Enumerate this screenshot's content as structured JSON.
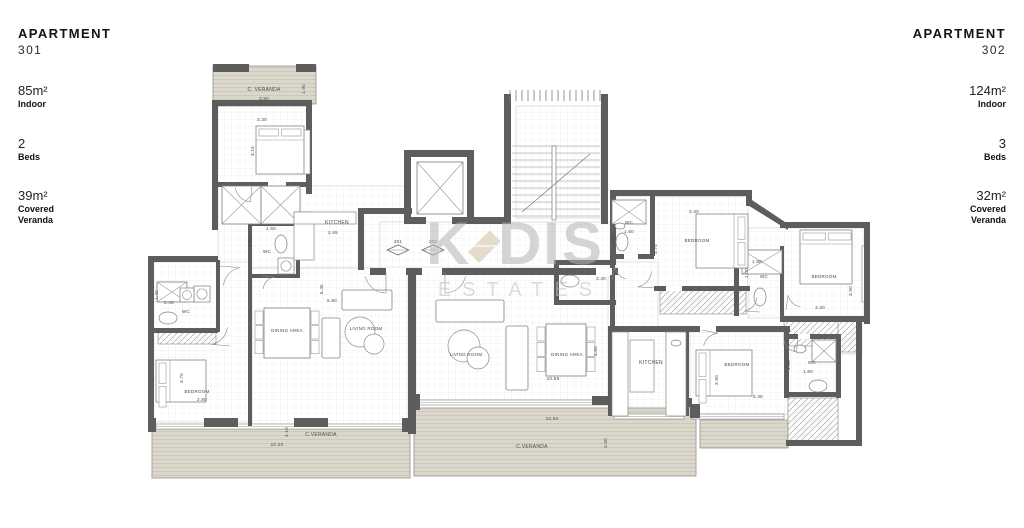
{
  "left_panel": {
    "title": "APARTMENT",
    "number": "301",
    "stats": [
      {
        "value": "85m²",
        "label": "Indoor"
      },
      {
        "value": "2",
        "label": "Beds"
      },
      {
        "value": "39m²",
        "label": "Covered\nVeranda"
      }
    ]
  },
  "right_panel": {
    "title": "APARTMENT",
    "number": "302",
    "stats": [
      {
        "value": "124m²",
        "label": "Indoor"
      },
      {
        "value": "3",
        "label": "Beds"
      },
      {
        "value": "32m²",
        "label": "Covered\nVeranda"
      }
    ]
  },
  "watermark": {
    "k": "K",
    "dis": "DIS",
    "estates": "ESTATES"
  },
  "colors": {
    "wall": "#5d5d5d",
    "deck": "#dbd7ca",
    "deck_line": "#c9c5b8",
    "grid_line": "#ececec",
    "label": "#4a4a4a",
    "watermark_gray": "#b5b5b5",
    "watermark_diamond": "#d4c1a4"
  },
  "floorplan": {
    "interiors": [
      [
        218,
        106,
        92,
        78
      ],
      [
        218,
        186,
        190,
        82
      ],
      [
        152,
        262,
        98,
        160
      ],
      [
        252,
        268,
        156,
        156
      ],
      [
        380,
        222,
        236,
        46
      ],
      [
        516,
        106,
        85,
        112
      ],
      [
        612,
        196,
        136,
        92
      ],
      [
        556,
        262,
        60,
        40
      ],
      [
        612,
        262,
        46,
        66
      ],
      [
        748,
        228,
        116,
        90
      ],
      [
        416,
        270,
        192,
        130
      ],
      [
        612,
        330,
        76,
        84
      ],
      [
        690,
        332,
        98,
        82
      ],
      [
        788,
        338,
        48,
        58
      ],
      [
        788,
        396,
        50,
        46
      ],
      [
        838,
        318,
        24,
        36
      ]
    ],
    "verandas": [
      [
        213,
        66,
        103,
        38
      ],
      [
        152,
        428,
        258,
        50
      ],
      [
        414,
        408,
        282,
        68
      ],
      [
        700,
        420,
        88,
        28
      ]
    ],
    "hatches": [
      [
        158,
        330,
        58,
        14
      ],
      [
        660,
        290,
        86,
        24
      ],
      [
        784,
        318,
        76,
        28
      ],
      [
        788,
        398,
        50,
        44
      ],
      [
        838,
        318,
        22,
        34
      ]
    ],
    "windows": [
      [
        218,
        101,
        90,
        5
      ],
      [
        156,
        424,
        250,
        5
      ],
      [
        416,
        400,
        192,
        5
      ],
      [
        656,
        191,
        88,
        5
      ],
      [
        862,
        246,
        5,
        56
      ],
      [
        692,
        414,
        92,
        5
      ],
      [
        614,
        414,
        70,
        5
      ]
    ],
    "walls": [
      [
        213,
        64,
        36,
        8
      ],
      [
        296,
        64,
        20,
        8
      ],
      [
        212,
        100,
        6,
        130
      ],
      [
        148,
        256,
        70,
        6
      ],
      [
        148,
        256,
        6,
        170
      ],
      [
        212,
        100,
        100,
        6
      ],
      [
        306,
        100,
        6,
        94
      ],
      [
        216,
        182,
        96,
        5
      ],
      [
        248,
        222,
        52,
        4
      ],
      [
        248,
        222,
        4,
        56
      ],
      [
        296,
        222,
        4,
        56
      ],
      [
        248,
        274,
        52,
        4
      ],
      [
        216,
        260,
        4,
        72
      ],
      [
        148,
        328,
        70,
        5
      ],
      [
        248,
        278,
        4,
        148
      ],
      [
        358,
        208,
        54,
        6
      ],
      [
        358,
        208,
        6,
        62
      ],
      [
        408,
        268,
        8,
        166
      ],
      [
        370,
        268,
        248,
        7
      ],
      [
        404,
        150,
        70,
        7
      ],
      [
        404,
        150,
        7,
        74
      ],
      [
        467,
        150,
        7,
        74
      ],
      [
        404,
        217,
        22,
        7
      ],
      [
        452,
        217,
        22,
        7
      ],
      [
        504,
        94,
        7,
        130
      ],
      [
        601,
        94,
        7,
        130
      ],
      [
        472,
        217,
        34,
        7
      ],
      [
        610,
        190,
        6,
        74
      ],
      [
        610,
        190,
        142,
        6
      ],
      [
        650,
        196,
        5,
        60
      ],
      [
        610,
        254,
        44,
        5
      ],
      [
        654,
        286,
        96,
        5
      ],
      [
        746,
        190,
        6,
        16
      ],
      [
        780,
        222,
        90,
        6
      ],
      [
        864,
        222,
        6,
        102
      ],
      [
        780,
        246,
        4,
        70
      ],
      [
        734,
        246,
        5,
        70
      ],
      [
        610,
        260,
        5,
        72
      ],
      [
        554,
        260,
        62,
        5
      ],
      [
        554,
        260,
        5,
        44
      ],
      [
        554,
        300,
        62,
        5
      ],
      [
        610,
        326,
        180,
        6
      ],
      [
        608,
        326,
        6,
        90
      ],
      [
        684,
        330,
        5,
        86
      ],
      [
        784,
        332,
        5,
        66
      ],
      [
        784,
        334,
        56,
        5
      ],
      [
        836,
        334,
        5,
        64
      ],
      [
        784,
        392,
        56,
        5
      ],
      [
        780,
        316,
        90,
        6
      ],
      [
        856,
        318,
        6,
        128
      ],
      [
        786,
        440,
        76,
        6
      ],
      [
        204,
        418,
        34,
        9
      ],
      [
        294,
        418,
        34,
        9
      ],
      [
        148,
        418,
        8,
        14
      ],
      [
        402,
        418,
        12,
        14
      ],
      [
        592,
        396,
        26,
        9
      ],
      [
        666,
        398,
        26,
        9
      ],
      [
        412,
        394,
        8,
        16
      ],
      [
        690,
        404,
        10,
        14
      ]
    ],
    "polys": [
      "746,196 788,224 788,230 746,204"
    ],
    "gaps": [
      [
        386,
        268,
        20,
        7
      ],
      [
        422,
        268,
        20,
        7
      ],
      [
        596,
        268,
        16,
        7
      ],
      [
        268,
        182,
        18,
        5
      ],
      [
        624,
        254,
        14,
        5
      ],
      [
        700,
        326,
        16,
        6
      ],
      [
        666,
        286,
        16,
        5
      ],
      [
        798,
        334,
        12,
        5
      ]
    ],
    "xboxes": [
      [
        417,
        162,
        46,
        52
      ],
      [
        612,
        200,
        34,
        24
      ],
      [
        742,
        250,
        40,
        24
      ],
      [
        157,
        282,
        30,
        20
      ],
      [
        812,
        340,
        24,
        22
      ],
      [
        222,
        186,
        39,
        38
      ],
      [
        261,
        186,
        39,
        38
      ]
    ],
    "xcircles": [
      [
        278,
        258,
        16
      ],
      [
        194,
        286,
        16
      ],
      [
        180,
        288,
        14
      ]
    ],
    "rects": [
      [
        294,
        212,
        20,
        48
      ],
      [
        294,
        212,
        62,
        12
      ],
      [
        612,
        332,
        16,
        84
      ],
      [
        666,
        332,
        20,
        84
      ],
      [
        630,
        340,
        24,
        52
      ],
      [
        296,
        130,
        14,
        44
      ]
    ],
    "ovals": [
      [
        281,
        244,
        6,
        9
      ],
      [
        168,
        318,
        9,
        6
      ],
      [
        622,
        242,
        6,
        9
      ],
      [
        570,
        281,
        9,
        6
      ],
      [
        760,
        297,
        6,
        9
      ],
      [
        818,
        386,
        9,
        6
      ],
      [
        620,
        226,
        5,
        3
      ],
      [
        800,
        349,
        6,
        4
      ],
      [
        676,
        343,
        5,
        3
      ]
    ],
    "beds": [
      {
        "x": 256,
        "y": 126,
        "w": 48,
        "h": 48,
        "head": "top"
      },
      {
        "x": 156,
        "y": 360,
        "w": 50,
        "h": 42,
        "head": "left"
      },
      {
        "x": 696,
        "y": 214,
        "w": 52,
        "h": 54,
        "head": "right"
      },
      {
        "x": 800,
        "y": 230,
        "w": 52,
        "h": 54,
        "head": "top"
      },
      {
        "x": 696,
        "y": 350,
        "w": 56,
        "h": 46,
        "head": "left"
      }
    ],
    "sofas": [
      [
        342,
        290,
        50,
        20
      ],
      [
        436,
        300,
        68,
        22
      ],
      [
        506,
        326,
        22,
        64
      ],
      [
        322,
        318,
        18,
        40
      ]
    ],
    "circlesT": [
      [
        360,
        332,
        15
      ],
      [
        374,
        344,
        10
      ],
      [
        464,
        346,
        16
      ],
      [
        478,
        358,
        11
      ]
    ],
    "dtables": [
      [
        264,
        308,
        46,
        50
      ],
      [
        546,
        324,
        40,
        52
      ]
    ],
    "stairs": {
      "treads": {
        "x": 512,
        "y": 146,
        "w": 88,
        "gap": 7,
        "n": 11
      },
      "ticks": {
        "x": 510,
        "y": 90,
        "x2": 600,
        "h": 11,
        "gap": 6
      },
      "stringer": [
        552,
        146,
        4,
        74
      ],
      "arrow": [
        522,
        212,
        590,
        154
      ]
    },
    "arcs": [
      {
        "x": 386,
        "y": 272,
        "r": 21,
        "a0": 90,
        "a1": 168
      },
      {
        "x": 445,
        "y": 272,
        "r": 21,
        "a0": 90,
        "a1": 12,
        "sw": 0
      },
      {
        "x": 252,
        "y": 185,
        "r": 17,
        "a0": 95,
        "a1": 172
      },
      {
        "x": 220,
        "y": 266,
        "r": 20,
        "a0": 5,
        "a1": 80,
        "sw": 0
      },
      {
        "x": 230,
        "y": 346,
        "r": 19,
        "a0": 185,
        "a1": 262,
        "sw": 0
      },
      {
        "x": 262,
        "y": 276,
        "r": 13,
        "a0": 5,
        "a1": 85,
        "sw": 0
      },
      {
        "x": 655,
        "y": 288,
        "r": 17,
        "a0": 184,
        "a1": 258,
        "sw": 0
      },
      {
        "x": 612,
        "y": 280,
        "r": 14,
        "a0": 282,
        "a1": 355,
        "sw": 0
      },
      {
        "x": 760,
        "y": 312,
        "r": 15,
        "a0": 184,
        "a1": 258,
        "sw": 0
      },
      {
        "x": 702,
        "y": 330,
        "r": 16,
        "a0": 12,
        "a1": 84,
        "sw": 0
      },
      {
        "x": 798,
        "y": 338,
        "r": 14,
        "a0": 96,
        "a1": 168
      },
      {
        "x": 786,
        "y": 310,
        "r": 15,
        "a0": 278,
        "a1": 348,
        "sw": 0
      }
    ],
    "diamonds": [
      [
        398,
        250
      ],
      [
        433,
        250
      ]
    ],
    "labels": [
      {
        "t": "C. VERANDA",
        "x": 264,
        "y": 91,
        "s": 5
      },
      {
        "t": "3.90",
        "x": 264,
        "y": 100
      },
      {
        "t": "1.90",
        "x": 305,
        "y": 89,
        "r": -90
      },
      {
        "t": "3.30",
        "x": 262,
        "y": 121
      },
      {
        "t": "3.15",
        "x": 254,
        "y": 151,
        "r": -90
      },
      {
        "t": "KITCHEN",
        "x": 337,
        "y": 224,
        "s": 5
      },
      {
        "t": "2.65",
        "x": 333,
        "y": 234
      },
      {
        "t": "1.50",
        "x": 271,
        "y": 230
      },
      {
        "t": "2.60",
        "x": 251,
        "y": 242,
        "r": -90
      },
      {
        "t": "WC",
        "x": 267,
        "y": 253,
        "s": 4.5
      },
      {
        "t": "2.40",
        "x": 169,
        "y": 304
      },
      {
        "t": "1.40",
        "x": 158,
        "y": 295,
        "r": -90
      },
      {
        "t": "WC",
        "x": 186,
        "y": 313,
        "s": 4.5
      },
      {
        "t": "BEDROOM",
        "x": 197,
        "y": 393,
        "s": 4.5
      },
      {
        "t": "3.75",
        "x": 183,
        "y": 378,
        "r": -90
      },
      {
        "t": "2.80",
        "x": 202,
        "y": 401
      },
      {
        "t": "DINING AREA",
        "x": 287,
        "y": 332,
        "s": 4.5
      },
      {
        "t": "LIVING ROOM",
        "x": 366,
        "y": 330,
        "s": 4.5
      },
      {
        "t": "6.45",
        "x": 323,
        "y": 289,
        "r": -90
      },
      {
        "t": "5.90",
        "x": 332,
        "y": 302
      },
      {
        "t": "C.VERANDA",
        "x": 321,
        "y": 436,
        "s": 5
      },
      {
        "t": "10.20",
        "x": 277,
        "y": 446
      },
      {
        "t": "4.10",
        "x": 288,
        "y": 432,
        "r": -90
      },
      {
        "t": "301",
        "x": 398,
        "y": 243,
        "s": 4.5
      },
      {
        "t": "302",
        "x": 433,
        "y": 243,
        "s": 4.5
      },
      {
        "t": "WC",
        "x": 629,
        "y": 224,
        "s": 4.5
      },
      {
        "t": "1.60",
        "x": 629,
        "y": 233
      },
      {
        "t": "2.50",
        "x": 615,
        "y": 240,
        "r": -90
      },
      {
        "t": "3.40",
        "x": 694,
        "y": 213
      },
      {
        "t": "BEDROOM",
        "x": 697,
        "y": 242,
        "s": 4.5
      },
      {
        "t": "3.70",
        "x": 657,
        "y": 249,
        "r": -90
      },
      {
        "t": "3.40",
        "x": 601,
        "y": 280
      },
      {
        "t": "1.50",
        "x": 757,
        "y": 263
      },
      {
        "t": "1.00",
        "x": 748,
        "y": 273,
        "r": -90
      },
      {
        "t": "WC",
        "x": 764,
        "y": 278,
        "s": 4.5
      },
      {
        "t": "BEDROOM",
        "x": 824,
        "y": 278,
        "s": 4.5
      },
      {
        "t": "3.30",
        "x": 820,
        "y": 309
      },
      {
        "t": "3.90",
        "x": 852,
        "y": 291,
        "r": -90
      },
      {
        "t": "LIVING ROOM",
        "x": 466,
        "y": 356,
        "s": 4.5
      },
      {
        "t": "DINING AREA",
        "x": 567,
        "y": 356,
        "s": 4.5
      },
      {
        "t": "10.55",
        "x": 553,
        "y": 380
      },
      {
        "t": "3.50",
        "x": 597,
        "y": 351,
        "r": -90
      },
      {
        "t": "KITCHEN",
        "x": 651,
        "y": 364,
        "s": 5
      },
      {
        "t": "BEDROOM",
        "x": 737,
        "y": 366,
        "s": 4.5
      },
      {
        "t": "3.90",
        "x": 718,
        "y": 380,
        "r": -90
      },
      {
        "t": "5.35",
        "x": 758,
        "y": 398
      },
      {
        "t": "WC",
        "x": 812,
        "y": 364,
        "s": 4.5
      },
      {
        "t": "1.80",
        "x": 808,
        "y": 373
      },
      {
        "t": "1.60",
        "x": 790,
        "y": 365,
        "r": -90
      },
      {
        "t": "C.VERANDA",
        "x": 532,
        "y": 448,
        "s": 5
      },
      {
        "t": "10.50",
        "x": 552,
        "y": 420
      },
      {
        "t": "3.00",
        "x": 607,
        "y": 443,
        "r": -90
      }
    ]
  }
}
